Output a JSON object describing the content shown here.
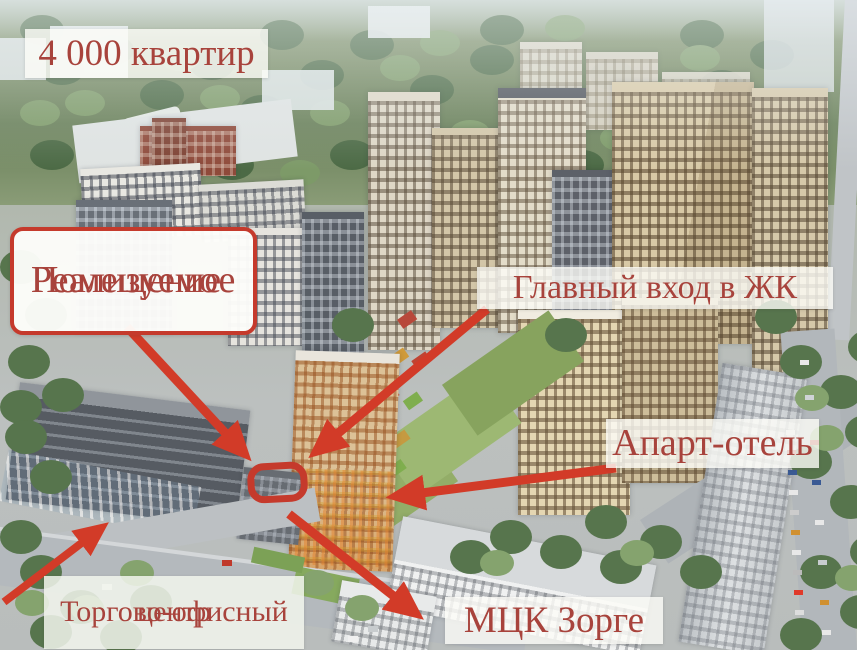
{
  "colors": {
    "arrow_red": "#d23b28",
    "box_border_red": "#c53a2c",
    "label_text_red": "#a8433c"
  },
  "labels": {
    "apartments": {
      "text": "4 000 квартир"
    },
    "property": {
      "line1": "Реализуемое",
      "line2": "Помещение"
    },
    "entrance": {
      "text": "Главный вход в ЖК"
    },
    "apart_hotel": {
      "text": "Апарт-отель"
    },
    "office_center": {
      "line1": "Торгово-офисный",
      "line2": "центр"
    },
    "mck": {
      "text": "МЦК Зорге"
    }
  }
}
